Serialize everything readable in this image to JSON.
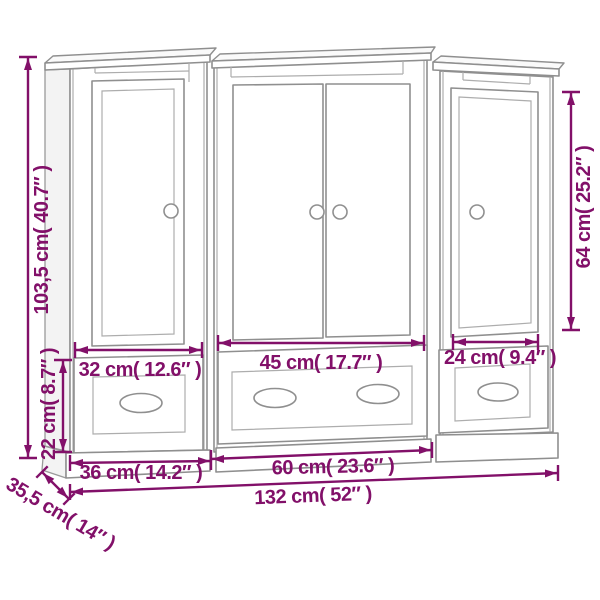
{
  "diagram": {
    "type": "furniture-dimension-diagram",
    "colors": {
      "dimension_annotation": "#821069",
      "cabinet_outline": "#8f8f8f",
      "background": "#ffffff"
    },
    "dimensions": {
      "total_height": "103,5 cm( 40.7″ )",
      "right_door_height": "64 cm( 25.2″ )",
      "left_drawer_height": "22 cm( 8.7″ )",
      "left_drawer_width": "32 cm( 12.6″ )",
      "middle_drawer_width": "45 cm( 17.7″ )",
      "right_drawer_width": "24 cm( 9.4″ )",
      "left_unit_width": "36 cm( 14.2″ )",
      "middle_unit_width": "60 cm( 23.6″ )",
      "total_width": "132 cm( 52″ )",
      "depth": "35,5 cm( 14″ )"
    }
  }
}
